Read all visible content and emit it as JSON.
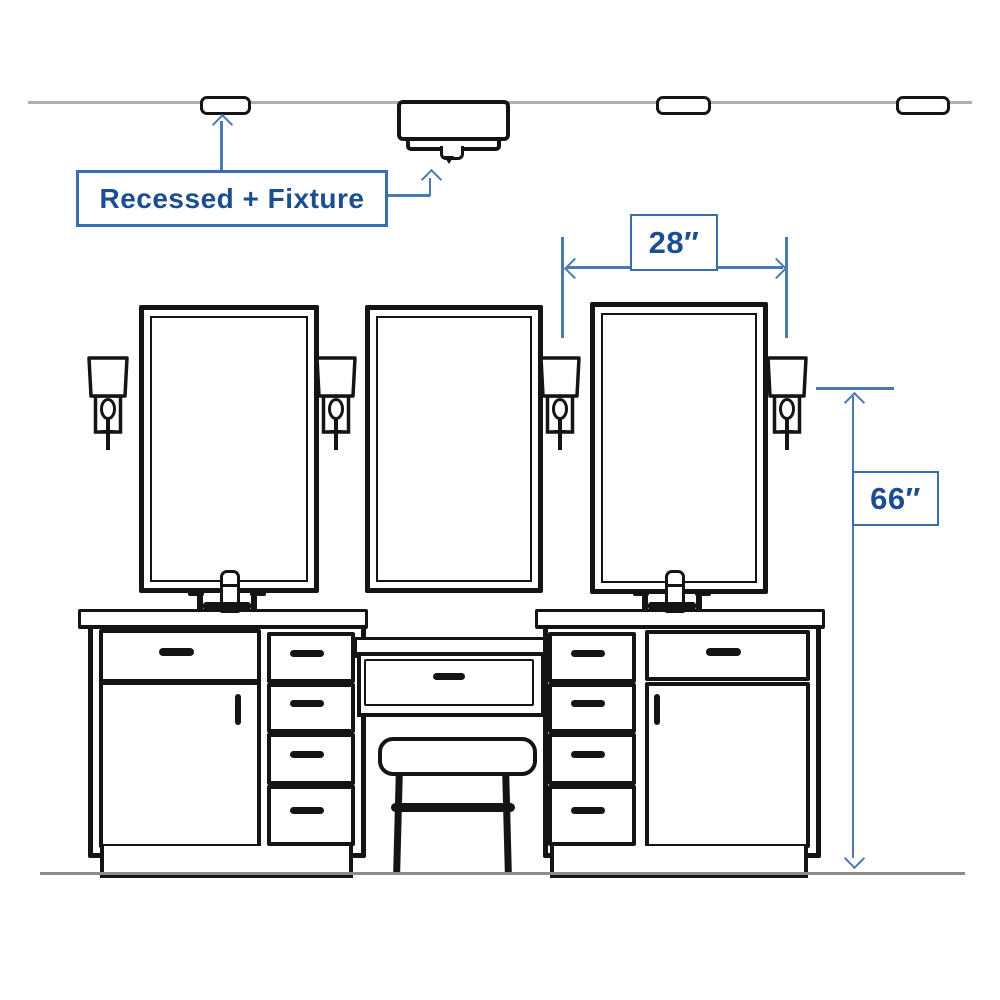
{
  "scene": {
    "type": "bathroom-vanity-lighting-dimension-diagram",
    "callout": {
      "label": "Recessed + Fixture"
    },
    "dimensions": [
      {
        "id": "sconce-spacing",
        "value": "28″"
      },
      {
        "id": "sconce-height-from-floor",
        "value": "66″"
      }
    ],
    "elements": {
      "recessed_lights": 3,
      "ceiling_fixtures": 1,
      "mirrors": 3,
      "wall_sconces": 4,
      "vanity_cabinets": 2,
      "faucets": 2,
      "makeup_drawers": 1,
      "stools": 1
    }
  },
  "colors": {
    "ink": "#141414",
    "dimension_blue": "#4b79b6",
    "label_border_blue": "#3a6cb0",
    "label_text_blue": "#1b4e91",
    "ceiling_gray": "#b0b0b0",
    "floor_gray": "#8c8c8c",
    "bg": "#ffffff"
  }
}
